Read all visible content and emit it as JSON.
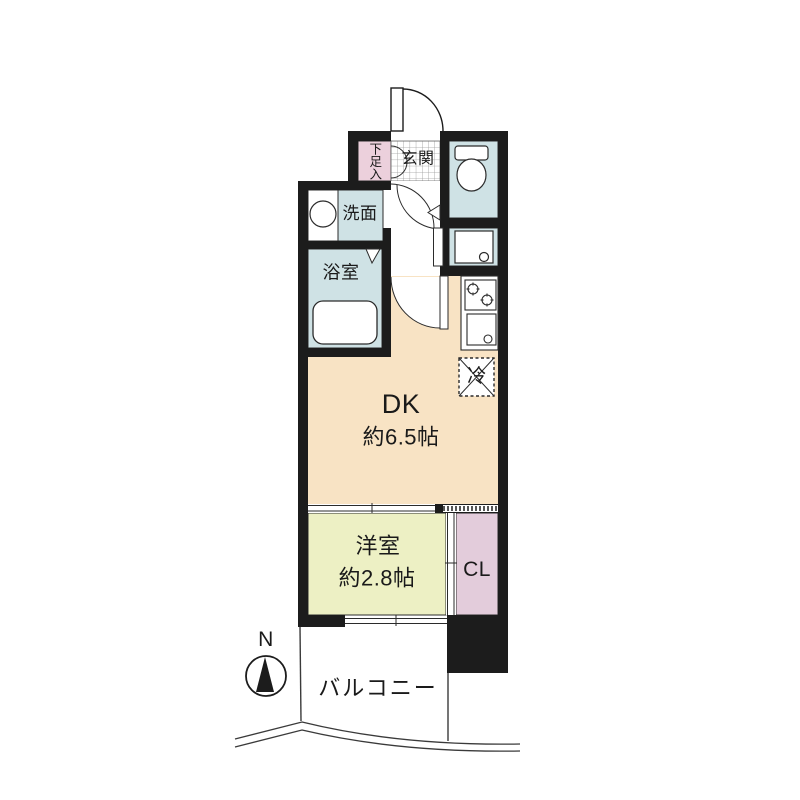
{
  "floor_plan": {
    "compass": {
      "north_label": "N"
    },
    "rooms": {
      "entrance": {
        "name": "玄関"
      },
      "shoe_cabinet": {
        "name": "下足入"
      },
      "washroom": {
        "name": "洗面"
      },
      "bathroom": {
        "name": "浴室"
      },
      "dining_kitchen": {
        "name": "DK",
        "area": "約6.5帖"
      },
      "western_room": {
        "name": "洋室",
        "area": "約2.8帖"
      },
      "closet": {
        "name": "CL"
      },
      "balcony": {
        "name": "バルコニー"
      },
      "refrigerator_space": {
        "name": "冷"
      }
    },
    "colors": {
      "wall": "#1c1c1c",
      "dk": "#f8e3c4",
      "western_room": "#edf0c4",
      "closet": "#e3ccdb",
      "shoe_cabinet": "#ecd0dc",
      "wet_area": "#cfe2e5",
      "outline": "#2b2b2b"
    }
  }
}
